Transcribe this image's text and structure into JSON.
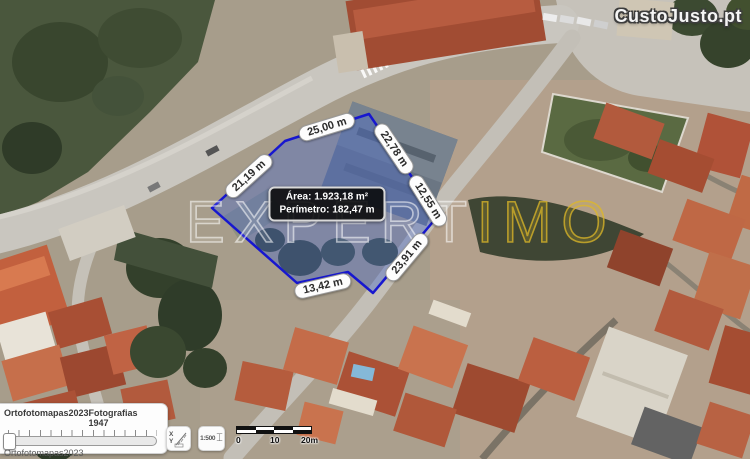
{
  "branding": {
    "watermark_left": "EXPERT",
    "watermark_right": "IMO",
    "site_watermark": "CustoJusto.pt"
  },
  "parcel": {
    "outline_color": "#1717cf",
    "fill_color": "rgba(75,105,200,0.42)",
    "info": {
      "area_label": "Área: 1.923,18 m²",
      "perimeter_label": "Perímetro: 182,47 m"
    },
    "measurements": [
      {
        "label": "25,00 m",
        "x": 327,
        "y": 127,
        "rot": -17
      },
      {
        "label": "22,78 m",
        "x": 394,
        "y": 149,
        "rot": 56
      },
      {
        "label": "12,55 m",
        "x": 428,
        "y": 201,
        "rot": 58
      },
      {
        "label": "23,91 m",
        "x": 407,
        "y": 257,
        "rot": -50
      },
      {
        "label": "13,42 m",
        "x": 323,
        "y": 286,
        "rot": -13
      },
      {
        "label": "21,19 m",
        "x": 249,
        "y": 176,
        "rot": -42
      }
    ]
  },
  "layers_panel": {
    "option_left": "Ortofotomapas2023",
    "option_right": "Fotografias 1947",
    "selected": "Ortofotomapas2023"
  },
  "map_tools": {
    "scale_ratio": "1:500",
    "scale_bar": {
      "start": "0",
      "mid": "10",
      "end": "20m"
    }
  }
}
